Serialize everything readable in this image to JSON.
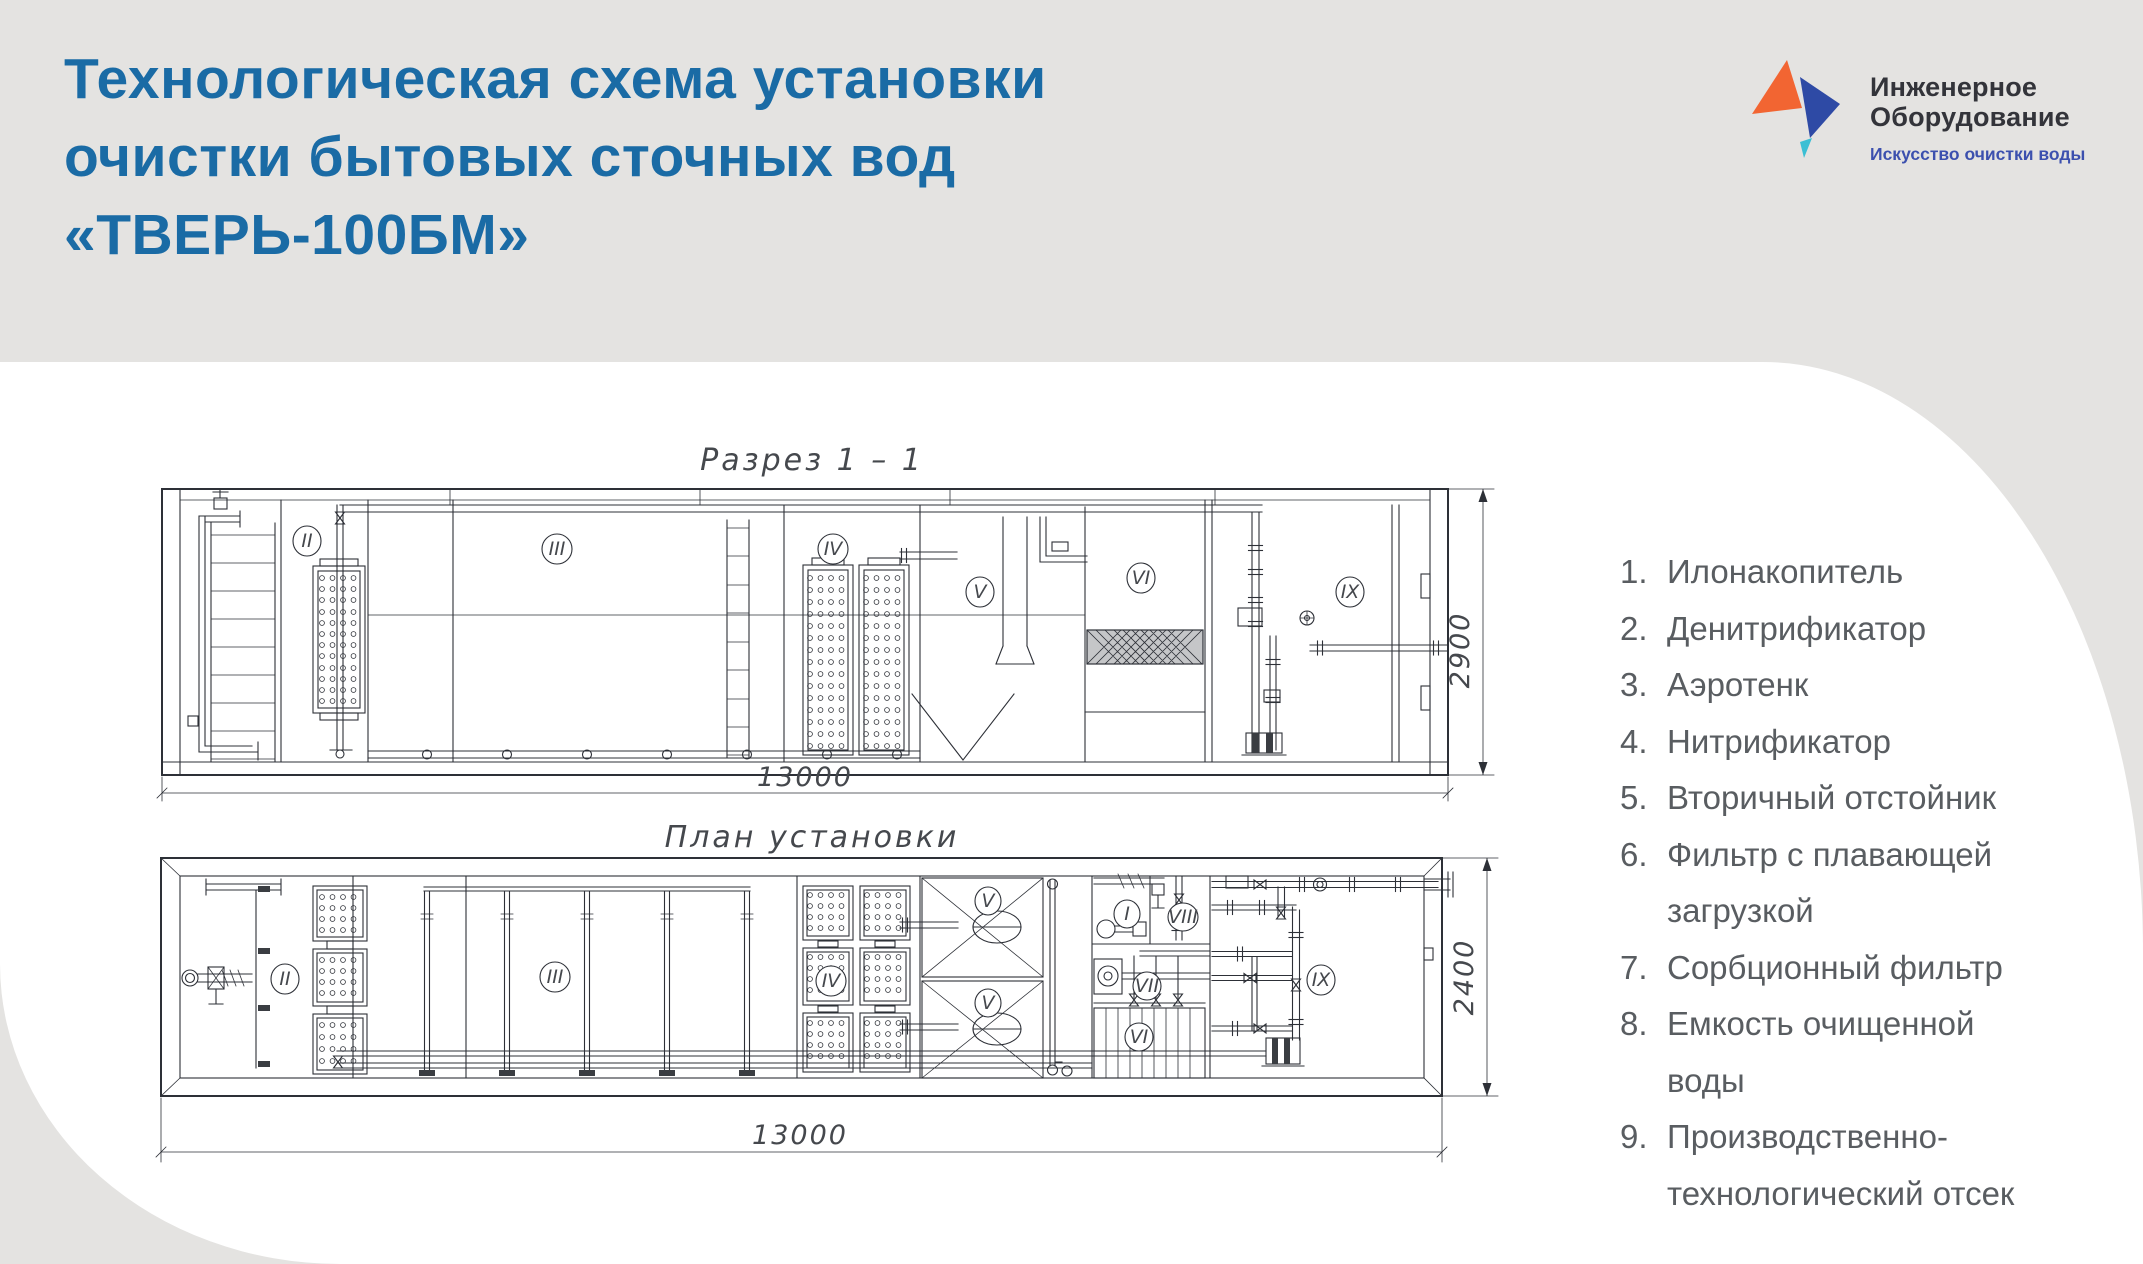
{
  "header": {
    "title_line1": "Технологическая схема установки",
    "title_line2": "очистки бытовых сточных вод",
    "title_line3": "«ТВЕРЬ-100БМ»"
  },
  "logo": {
    "name_line1": "Инженерное",
    "name_line2": "Оборудование",
    "tagline": "Искусство очистки воды",
    "orange": "#f26532",
    "blue": "#2e4aa5",
    "teal": "#3bbfd4"
  },
  "drawings": {
    "section": {
      "title": "Разрез  1 – 1",
      "width_dim": "13000",
      "height_dim": "2900",
      "labels": {
        "s2": "II",
        "s3": "III",
        "s4": "IV",
        "s5": "V",
        "s6": "VI",
        "s9": "IX"
      }
    },
    "plan": {
      "title": "План  установки",
      "width_dim": "13000",
      "height_dim": "2400",
      "labels": {
        "p1": "I",
        "p2": "II",
        "p3": "III",
        "p4": "IV",
        "p5a": "V",
        "p5b": "V",
        "p6": "VI",
        "p7": "VII",
        "p8": "VIII",
        "p9": "IX"
      }
    }
  },
  "legend": {
    "items": [
      {
        "num": "1.",
        "text": "Илонакопитель"
      },
      {
        "num": "2.",
        "text": "Денитрификатор"
      },
      {
        "num": "3.",
        "text": "Аэротенк"
      },
      {
        "num": "4.",
        "text": "Нитрификатор"
      },
      {
        "num": "5.",
        "text": "Вторичный отстойник"
      },
      {
        "num": "6.",
        "text": "Фильтр с плавающей загрузкой"
      },
      {
        "num": "7.",
        "text": "Сорбционный фильтр"
      },
      {
        "num": "8.",
        "text": "Емкость очищенной воды"
      },
      {
        "num": "9.",
        "text": "Производственно-технологический отсек"
      }
    ]
  }
}
